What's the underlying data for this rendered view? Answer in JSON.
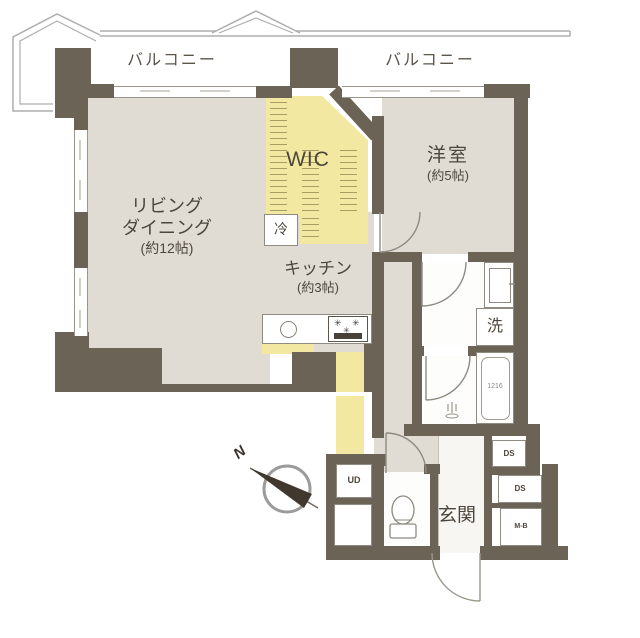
{
  "plan": {
    "balcony_left": "バルコニー",
    "balcony_right": "バルコニー",
    "living": {
      "line1": "リビング",
      "line2": "ダイニング",
      "line3": "(約12帖)"
    },
    "wic": "WIC",
    "western": {
      "line1": "洋室",
      "line2": "(約5帖)"
    },
    "kitchen": {
      "line1": "キッチン",
      "line2": "(約3帖)"
    },
    "fridge": "冷",
    "washer": "洗",
    "bathtub_size": "1216",
    "entrance": "玄関",
    "under_floor_storage": "UD",
    "duct_space_upper": "DS",
    "duct_space_lower": "DS",
    "meter_box": "M-B",
    "compass_north": "N"
  },
  "colors": {
    "wall": "#6b6456",
    "room_floor": "#e0dcd4",
    "highlight_floor": "#f2e8a2",
    "balcony_outline": "#adadad",
    "text": "#4d463c"
  }
}
